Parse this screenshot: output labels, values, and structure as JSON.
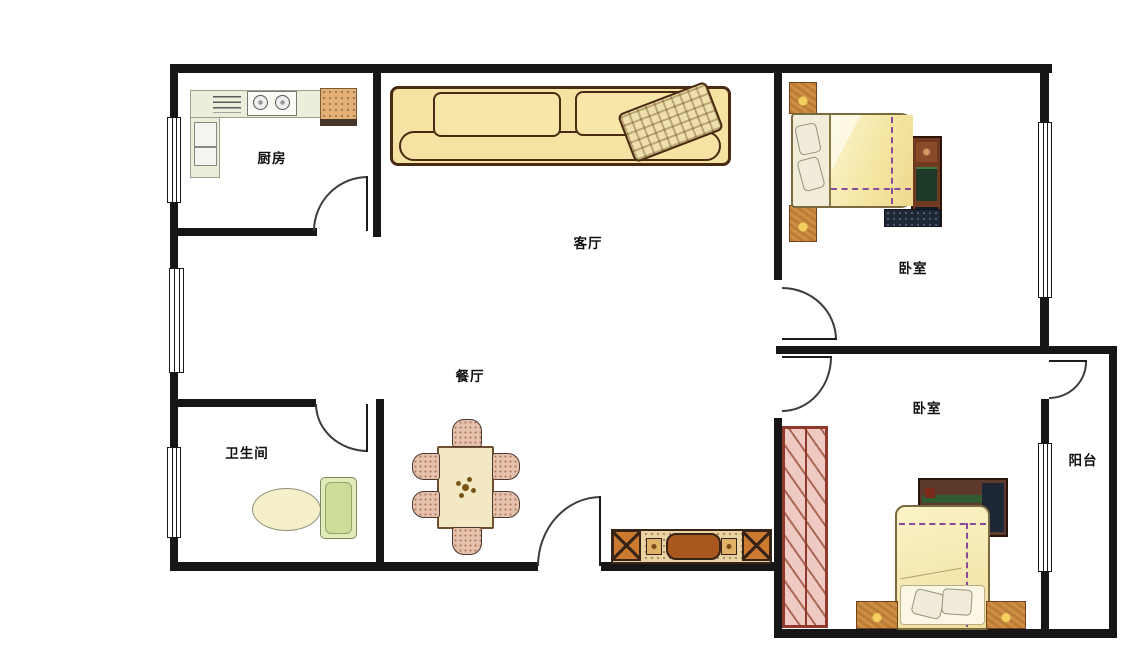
{
  "floor_plan": {
    "type": "apartment-floor-plan",
    "rooms": {
      "kitchen": {
        "label": "厨房"
      },
      "living_room": {
        "label": "客厅"
      },
      "bedroom_top": {
        "label": "卧室"
      },
      "dining_room": {
        "label": "餐厅"
      },
      "bathroom": {
        "label": "卫生间"
      },
      "bedroom_bottom": {
        "label": "卧室"
      },
      "balcony": {
        "label": "阳台"
      }
    },
    "icons": {
      "sofa-icon": "three-seat sofa with plaid pillow",
      "counter-icon": "L-shaped kitchen counter",
      "stove-icon": "two-burner cooktop",
      "range-vent-icon": "vent grille lines",
      "sink-icon": "speckled sink block",
      "fridge-icon": "two-door refrigerator",
      "bed-icon": "double bed with purple seam quilt and pillows",
      "nightstand-icon": "square wooden bedside table",
      "dresser-icon": "dark wood dresser chest",
      "wardrobe-icon": "tall hatched wardrobe",
      "dining-table-icon": "six-seat dining table with centerpiece",
      "chair-icon": "upholstered dining chair",
      "tv-cabinet-icon": "sideboard with X-front doors and TV",
      "toilet-icon": "toilet bowl with green tank",
      "window-icon": "triple-line window",
      "door-icon": "quarter-arc swing door"
    },
    "colors": {
      "wall": "#161616",
      "floor": "#ffffff",
      "sofa_fill": "#f4e3a2",
      "outline_brown": "#4a2a12",
      "quilt_yellow": "#f6ecb0",
      "seam_purple": "#8a4a9a",
      "wood_orange": "#cf8f42",
      "wardrobe_pink": "#eecac2",
      "wardrobe_red": "#8f3a2a",
      "counter_green": "#eaeeda",
      "sink_tan": "#e3b078",
      "tank_green": "#e1ebba",
      "chair_pink": "#e6c2ae",
      "cabinet_tan": "#ebd3a4",
      "tv_brown": "#aa5a1e",
      "dresser_dark": "#42291a"
    }
  }
}
